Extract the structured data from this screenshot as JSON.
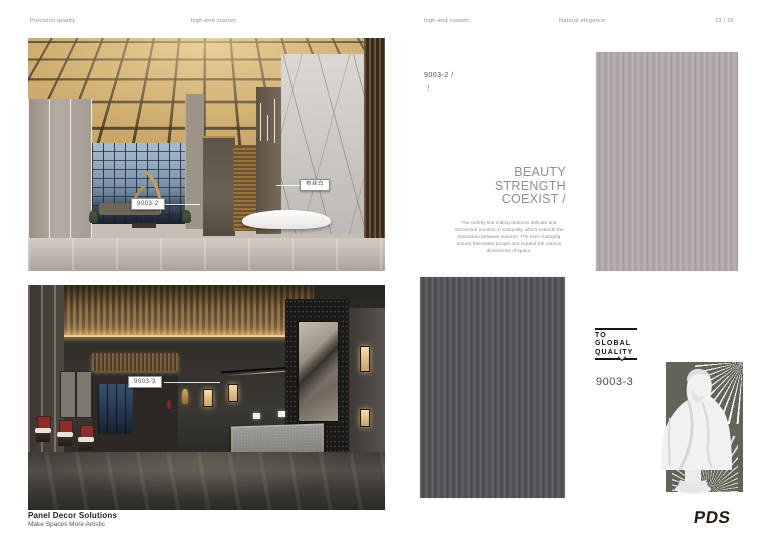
{
  "header": {
    "left_slogan_a": "Precision quality",
    "left_slogan_b": "high-end custom",
    "right_slogan_a": "high-end custom",
    "right_slogan_b": "Natural elegance",
    "page_number": "23 / 26"
  },
  "left_page": {
    "top_photo_tag": "9003-2",
    "top_photo_finish_tag": "布丝白",
    "bottom_photo_tag": "9003-3",
    "footer_brand": "Panel Decor Solutions",
    "footer_tagline": "Make Spaces More Artistic"
  },
  "right_page": {
    "product_code": "9003-2 /",
    "more_dots": "⋮",
    "headline_line1": "BEAUTY",
    "headline_line2": "STRENGTH",
    "headline_line3": "COEXIST /",
    "description": "The orderly line cutting deduces delicate and introverted emotion in tranquility, which extends the interaction between textures. The ever-changing texture fascinates people and expand the various dimensions of space.",
    "badge_line1": "TO GLOBAL",
    "badge_line2": "QUALITY",
    "product_code_2": "9003-3",
    "logo_text": "PDS",
    "colors": {
      "swatch_light": "#b0a8a9",
      "swatch_dark": "#55565a",
      "gold_accent": "#c39d5e"
    }
  }
}
